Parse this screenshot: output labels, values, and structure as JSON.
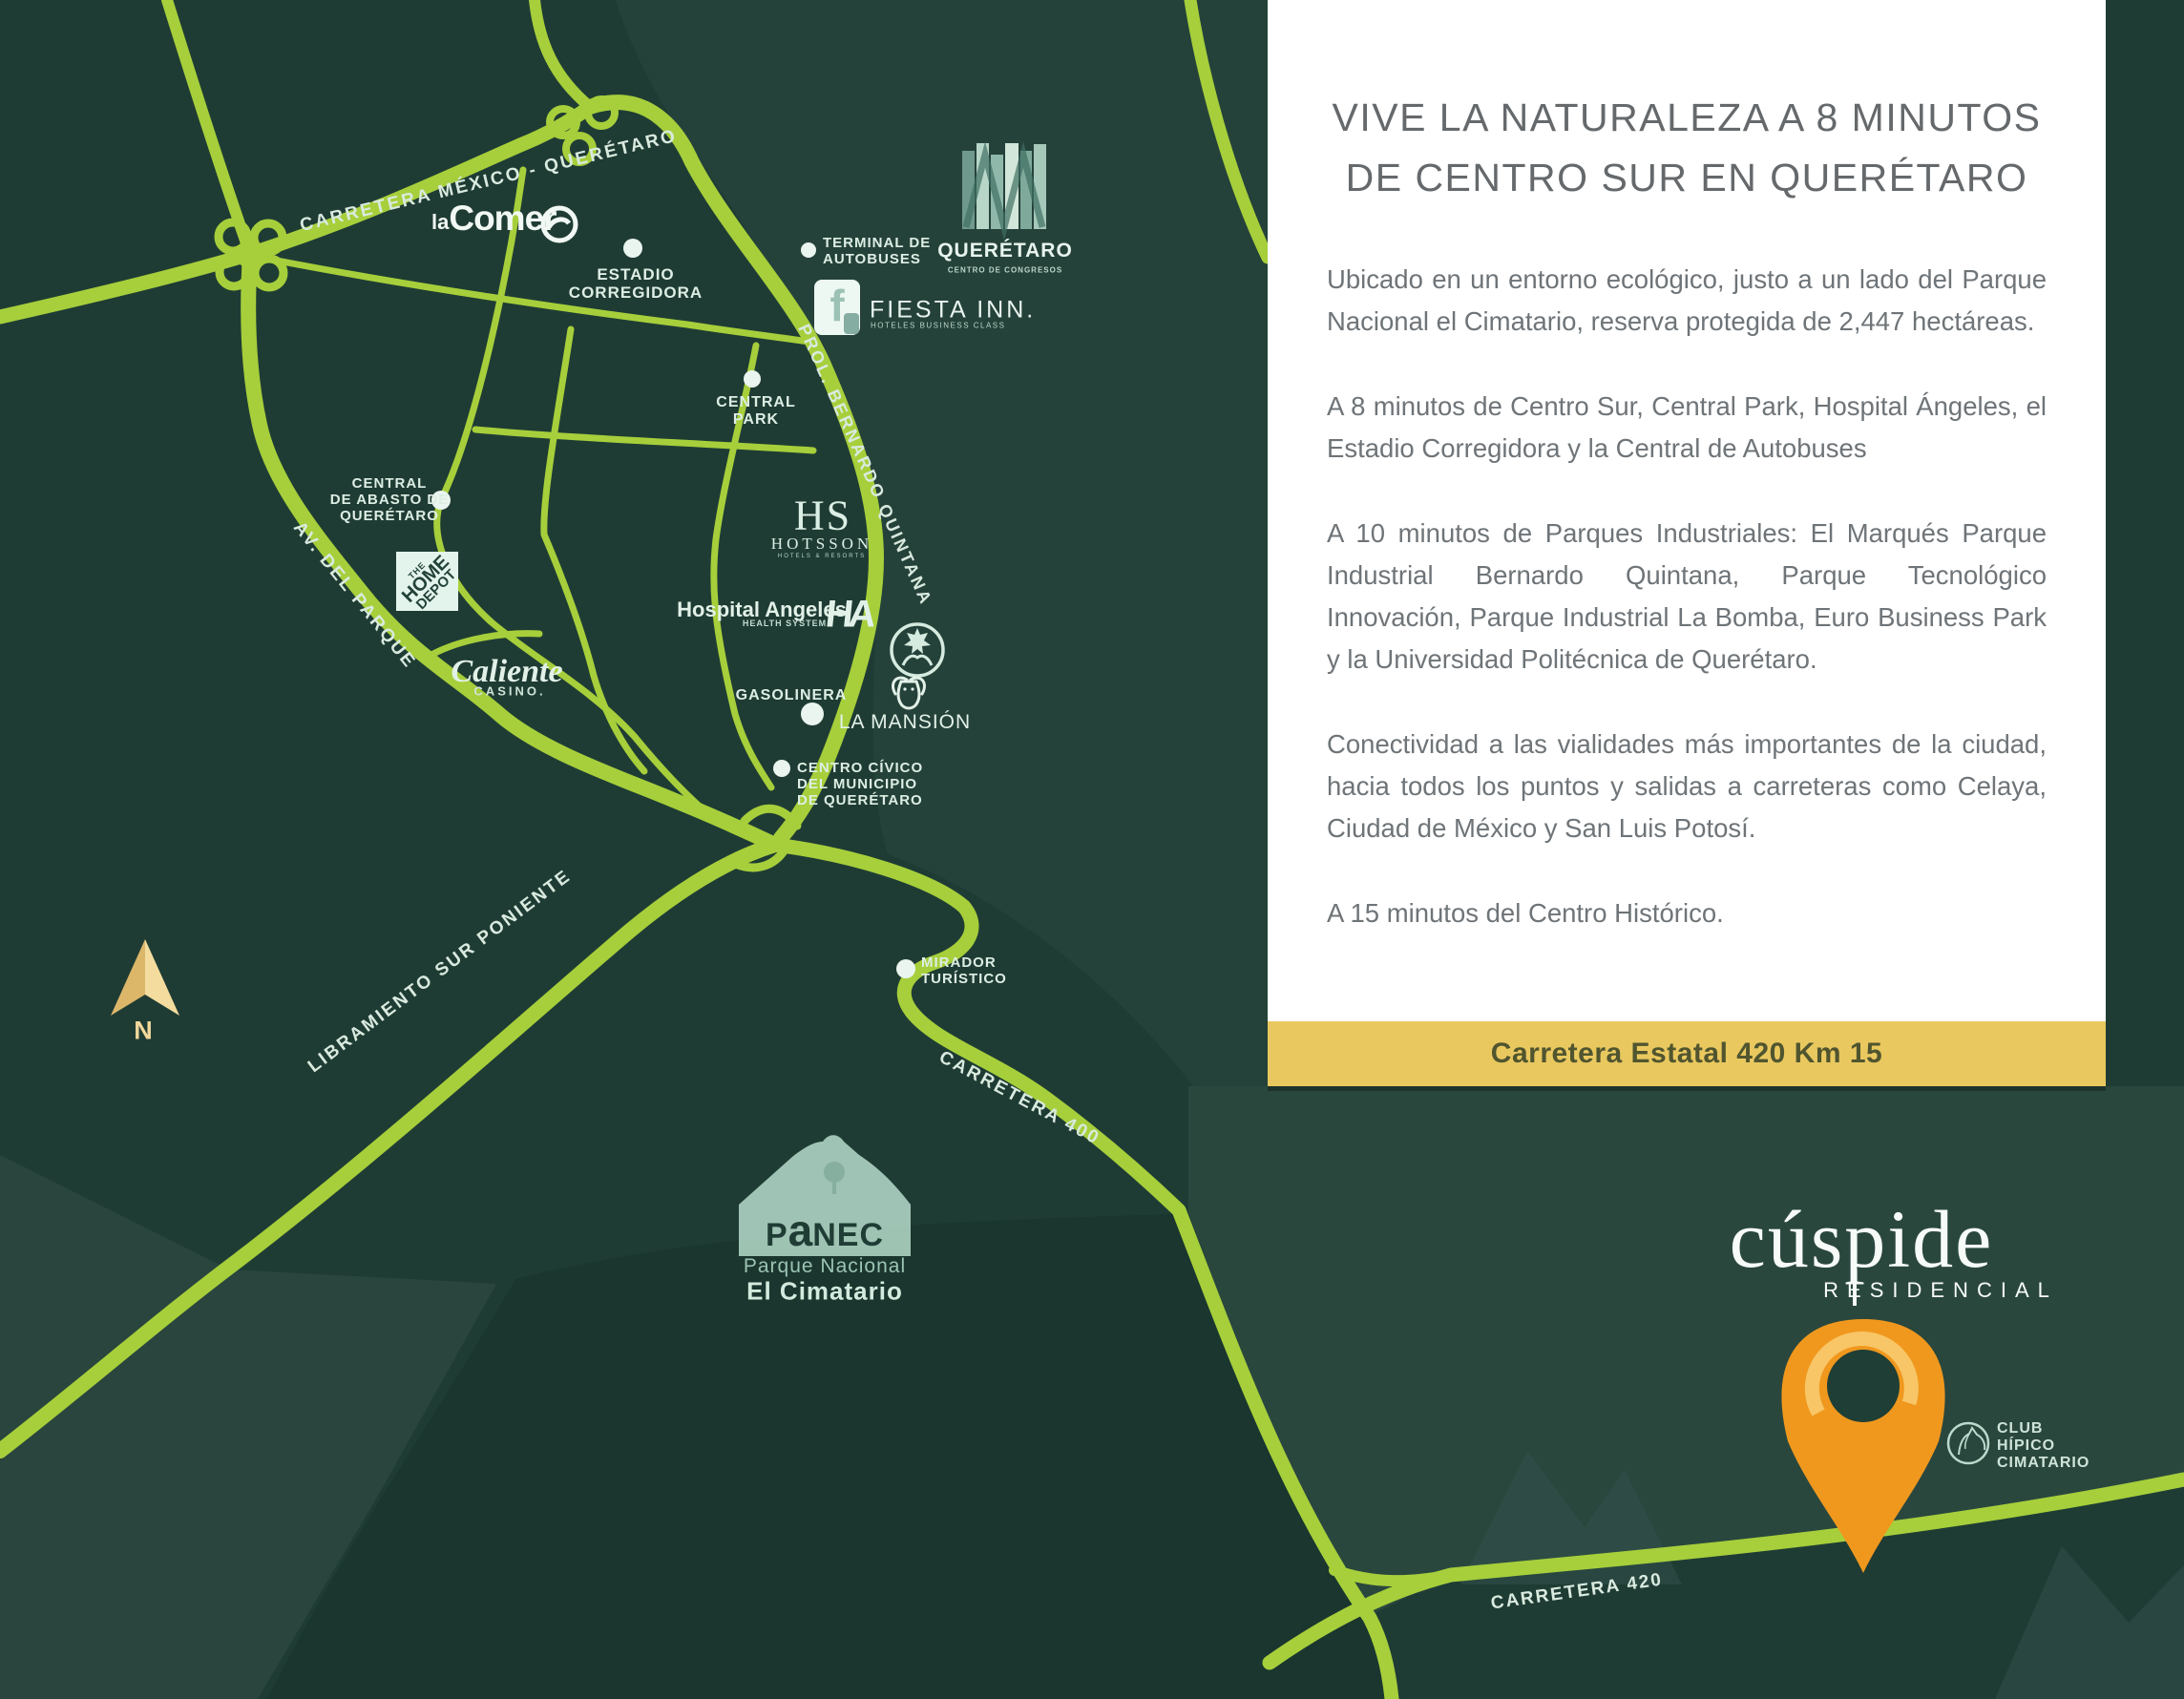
{
  "panel": {
    "title_lines": [
      "VIVE LA NATURALEZA A 8 MINUTOS",
      "DE CENTRO SUR EN QUERÉTARO"
    ],
    "paragraphs": [
      "Ubicado en un entorno ecológico, justo a un lado del Parque Nacional el Cimatario, reserva protegida de 2,447 hectáreas.",
      "A 8 minutos de Centro Sur, Central Park, Hospital Ángeles, el Estadio Corregidora y la Central de Autobuses",
      "A 10 minutos de Parques Industriales: El Marqués Parque Industrial Bernardo Quintana, Parque Tecnológico Innovación, Parque Industrial La Bomba, Euro Business Park y la Universidad Politécnica de Querétaro.",
      "Conectividad a las vialidades más importantes de la ciudad, hacia todos los puntos y salidas a carreteras como Celaya, Ciudad de México y San Luis Potosí.",
      "A 15 minutos del Centro Histórico."
    ],
    "banner": "Carretera Estatal 420 Km 15"
  },
  "brand": {
    "name": "cúspide",
    "sub": "RESIDENCIAL"
  },
  "club_hipico": {
    "lines": [
      "CLUB",
      "HÍPICO",
      "CIMATARIO"
    ]
  },
  "compass": {
    "label": "N"
  },
  "map": {
    "road_labels": [
      "CARRETERA  MÉXICO - QUERÉTARO",
      "PROL. BERNARDO QUINTANA",
      "AV. DEL PARQUE",
      "LIBRAMIENTO SUR PONIENTE",
      "CARRETERA 400",
      "CARRETERA 420"
    ],
    "pois": [
      {
        "lines": [
          "ESTADIO",
          "CORREGIDORA"
        ]
      },
      {
        "lines": [
          "TERMINAL DE",
          "AUTOBUSES"
        ]
      },
      {
        "lines": [
          "CENTRAL",
          "PARK"
        ]
      },
      {
        "lines": [
          "CENTRAL",
          "DE ABASTO DE",
          "QUERÉTARO"
        ]
      },
      {
        "lines": [
          "GASOLINERA"
        ]
      },
      {
        "lines": [
          "CENTRO CÍVICO",
          "DEL MUNICIPIO",
          "DE QUERÉTARO"
        ]
      },
      {
        "lines": [
          "MIRADOR",
          "TURÍSTICO"
        ]
      }
    ],
    "logos": {
      "lacomer_la": "la",
      "lacomer_comer": "Comer",
      "home_depot_lines": [
        "THE",
        "HOME",
        "DEPOT"
      ],
      "caliente": "Caliente",
      "caliente_sub": "CASINO.",
      "hotsson_hs": "HS",
      "hotsson": "HOTSSON",
      "hotsson_sub": "HOTELS & RESORTS",
      "hospital": "Hospital Angeles",
      "hospital_sub": "HEALTH SYSTEM",
      "hospital_mono": "HA",
      "fiesta": "FIESTA INN.",
      "fiesta_sub": "HOTELES BUSINESS CLASS",
      "fiesta_f": "f",
      "queretaro": "QUERÉTARO",
      "queretaro_sub": "CENTRO DE CONGRESOS",
      "mansion": "LA MANSIÓN",
      "panec_p": "P",
      "panec_a": "a",
      "panec_nec": "NEC",
      "panec_line1": "Parque Nacional",
      "panec_line2": "El Cimatario"
    }
  },
  "colors": {
    "map_bg": "#1f3c34",
    "road": "#a6cf3b",
    "panel_bg": "#ffffff",
    "banner_bg": "#e9c85f",
    "banner_text": "#50552f",
    "pin": "#f0981e",
    "label_mint": "#ddeee4",
    "compass_gold": "#f2d89b"
  }
}
